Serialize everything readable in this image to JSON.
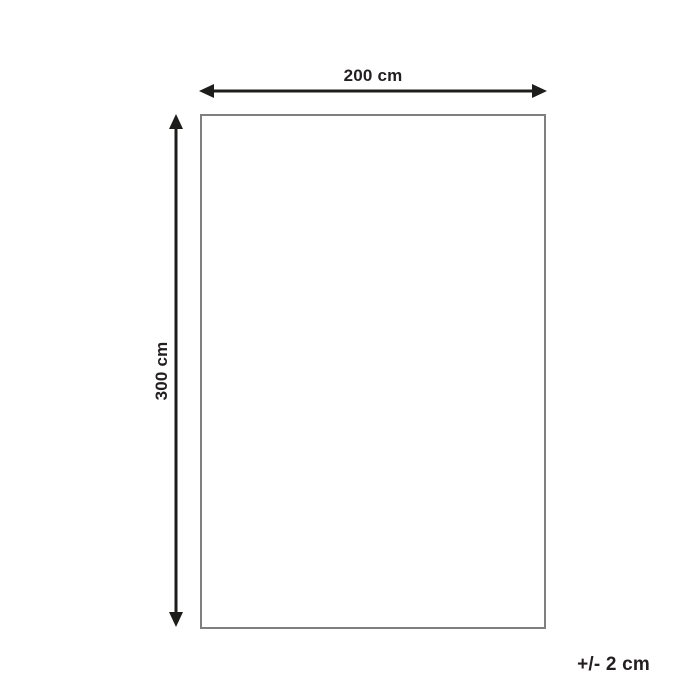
{
  "diagram": {
    "title": "product-dimension-diagram",
    "width_label": "200 cm",
    "height_label": "300 cm",
    "tolerance_label": "+/- 2 cm",
    "colors": {
      "background": "#ffffff",
      "arrow": "#1d1d1b",
      "rect_border": "#7f7f7f",
      "rect_fill": "none",
      "text": "#231f20"
    }
  }
}
